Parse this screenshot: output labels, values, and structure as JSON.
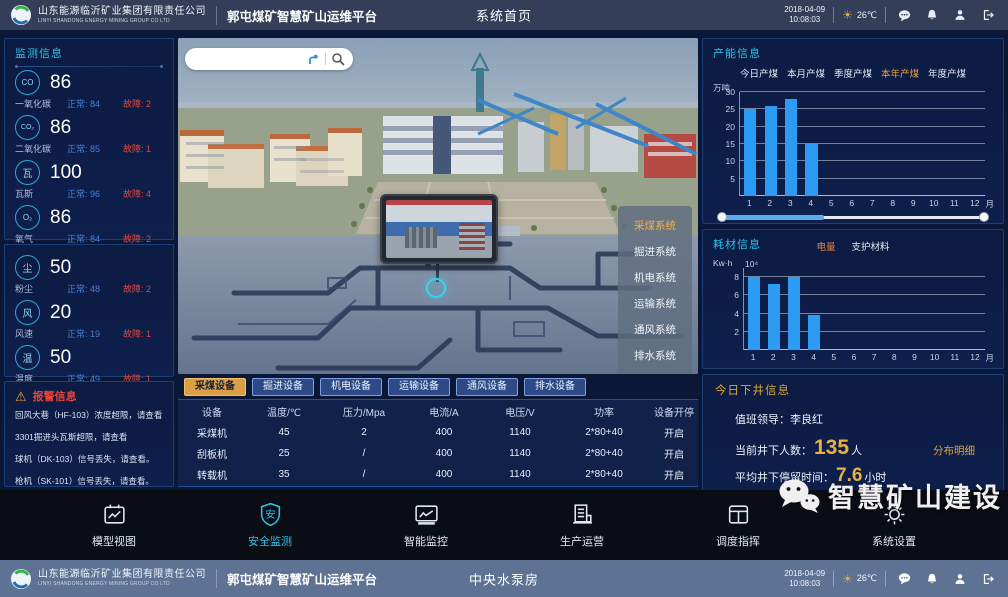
{
  "header": {
    "company_name": "山东能源临沂矿业集团有限责任公司",
    "company_name_en": "LINYI SHANDONG ENERGY MINING GROUP CO LTD",
    "platform_title": "郭屯煤矿智慧矿山运维平台",
    "page_title": "系统首页",
    "date": "2018-04-09",
    "time": "10:08:03",
    "temperature": "26℃"
  },
  "bottom_bar": {
    "page_title": "中央水泵房",
    "date": "2018-04-09",
    "time": "10:08:03",
    "temperature": "26℃"
  },
  "icons": {
    "weather": "sun-icon",
    "header_actions": [
      "message-icon",
      "bell-icon",
      "user-icon",
      "logout-icon"
    ],
    "search": [
      "locate-icon",
      "magnifier-icon"
    ],
    "alarm": "warning-triangle-icon",
    "watermark": "wechat-icon"
  },
  "monitoring": {
    "title": "监测信息",
    "sensors_a": [
      {
        "abbr": "CO",
        "value": "86",
        "label": "一氧化碳",
        "normal": "正常: 84",
        "fault": "故障: 2"
      },
      {
        "abbr": "CO₂",
        "value": "86",
        "label": "二氧化碳",
        "normal": "正常: 85",
        "fault": "故障: 1"
      },
      {
        "abbr": "瓦",
        "value": "100",
        "label": "瓦斯",
        "normal": "正常: 96",
        "fault": "故障: 4"
      },
      {
        "abbr": "O₂",
        "value": "86",
        "label": "氧气",
        "normal": "正常: 84",
        "fault": "故障: 2"
      }
    ],
    "sensors_b": [
      {
        "abbr": "尘",
        "value": "50",
        "label": "粉尘",
        "normal": "正常: 48",
        "fault": "故障: 2"
      },
      {
        "abbr": "风",
        "value": "20",
        "label": "风速",
        "normal": "正常: 19",
        "fault": "故障: 1"
      },
      {
        "abbr": "温",
        "value": "50",
        "label": "温度",
        "normal": "正常: 49",
        "fault": "故障: 1"
      }
    ]
  },
  "alarms": {
    "title": "报警信息",
    "items": [
      "回风大巷（HF-103）浓度超限，请查看",
      "3301掘进头瓦斯超限，请查看",
      "球机（DK-103）信号丢失，请查看。",
      "枪机（SK-101）信号丢失，请查看。"
    ]
  },
  "scene": {
    "search_value": "",
    "systems": [
      "采煤系统",
      "掘进系统",
      "机电系统",
      "运输系统",
      "通风系统",
      "排水系统"
    ],
    "active_system": "采煤系统"
  },
  "equipment": {
    "tabs": [
      "采煤设备",
      "掘进设备",
      "机电设备",
      "运输设备",
      "通风设备",
      "排水设备"
    ],
    "active_tab": "采煤设备",
    "columns": [
      "设备",
      "温度/℃",
      "压力/Mpa",
      "电流/A",
      "电压/V",
      "功率",
      "设备开停"
    ],
    "rows": [
      [
        "采煤机",
        "45",
        "2",
        "400",
        "1140",
        "2*80+40",
        "开启"
      ],
      [
        "刮板机",
        "25",
        "/",
        "400",
        "1140",
        "2*80+40",
        "开启"
      ],
      [
        "转载机",
        "35",
        "/",
        "400",
        "1140",
        "2*80+40",
        "开启"
      ]
    ]
  },
  "production": {
    "title": "产能信息",
    "tabs": [
      "今日产煤",
      "本月产煤",
      "季度产煤",
      "本年产煤",
      "年度产煤"
    ],
    "active_tab": "本年产煤"
  },
  "consumables": {
    "title": "耗材信息",
    "legend": [
      "电量",
      "支护材料"
    ],
    "active_legend": "电量",
    "unit": "Kw·h",
    "exponent": "10⁴"
  },
  "chart_data": [
    {
      "type": "bar",
      "title": "产能信息（本年产煤）",
      "categories": [
        "1",
        "2",
        "3",
        "4",
        "5",
        "6",
        "7",
        "8",
        "9",
        "10",
        "11",
        "12"
      ],
      "values": [
        25,
        26,
        28,
        15
      ],
      "xlabel": "月",
      "ylabel": "万吨",
      "ylim": [
        0,
        30
      ],
      "yticks": [
        "5",
        "10",
        "15",
        "20",
        "25",
        "30"
      ],
      "bar_color": "#2b9bf4",
      "grid": true,
      "zoom_slider": true
    },
    {
      "type": "bar",
      "title": "耗材信息（电量）",
      "categories": [
        "1",
        "2",
        "3",
        "4",
        "5",
        "6",
        "7",
        "8",
        "9",
        "10",
        "11",
        "12"
      ],
      "values": [
        8,
        7.2,
        8,
        3.8
      ],
      "xlabel": "月",
      "ylabel": "Kw·h ×10⁴",
      "ylim": [
        0,
        9
      ],
      "yticks": [
        "2",
        "4",
        "6",
        "8"
      ],
      "bar_color": "#2b9bf4",
      "grid": true,
      "zoom_slider": false
    }
  ],
  "underground": {
    "title": "今日下井信息",
    "leader_label": "值班领导：",
    "leader_name": "李良红",
    "count_label": "当前井下人数：",
    "count_value": "135",
    "count_unit": "人",
    "detail_link": "分布明细",
    "duration_label": "平均井下停留时间：",
    "duration_value": "7.6",
    "duration_unit": "小时"
  },
  "nav": {
    "items": [
      {
        "label": "模型视图",
        "icon": "model-view-icon"
      },
      {
        "label": "安全监测",
        "icon": "safety-monitor-icon"
      },
      {
        "label": "智能监控",
        "icon": "smart-surveillance-icon"
      },
      {
        "label": "生产运营",
        "icon": "production-operation-icon"
      },
      {
        "label": "调度指挥",
        "icon": "dispatch-command-icon"
      },
      {
        "label": "系统设置",
        "icon": "system-settings-icon"
      }
    ],
    "active": "安全监测"
  },
  "watermark": {
    "text": "智慧矿山建设"
  },
  "theme": {
    "accent_cyan": "#2cc2e8",
    "accent_orange": "#e8a33d",
    "bar_blue": "#2b9bf4",
    "alarm_red": "#e8443c",
    "normal_blue": "#4a7fd6"
  }
}
